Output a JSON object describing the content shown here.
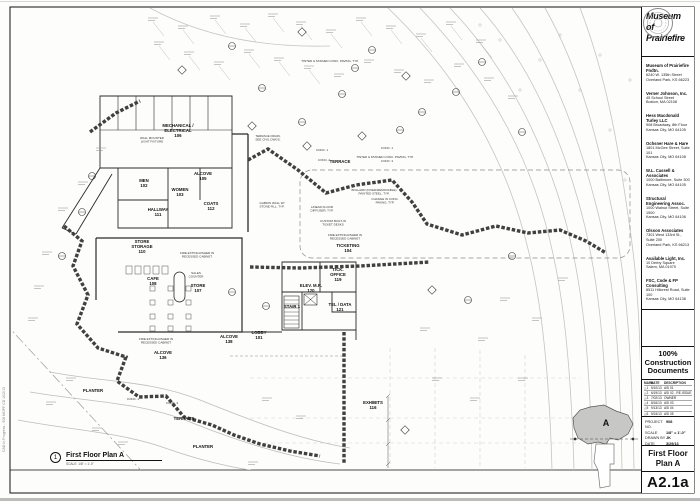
{
  "titleblock": {
    "firm": [
      "Museum",
      "of",
      "Prairiefire"
    ],
    "consultants": [
      {
        "name": "Museum of Prairiefire Fndtn.",
        "addr1": "6240 W. 135th Street",
        "addr2": "Overland Park, KS 66223"
      },
      {
        "name": "Verner Johnson, Inc.",
        "addr1": "45 School Street",
        "addr2": "Boston, MA 02108"
      },
      {
        "name": "Hess Macdonald Turley LLC",
        "addr1": "908 Broadway, 8th Floor",
        "addr2": "Kansas City, MO 64105"
      },
      {
        "name": "Ochsner Hare & Hare",
        "addr1": "1801 McGee Street, Suite 101",
        "addr2": "Kansas City, MO 64108"
      },
      {
        "name": "W.L. Cassell & Associates",
        "addr1": "1000 Baltimore, Suite 300",
        "addr2": "Kansas City, MO 64105"
      },
      {
        "name": "Structural Engineering Assoc.",
        "addr1": "1000 Walnut Street, Suite 1500",
        "addr2": "Kansas City, MO 64106"
      },
      {
        "name": "Olsson Associates",
        "addr1": "7301 West 133rd St., Suite 200",
        "addr2": "Overland Park, KS 66213"
      },
      {
        "name": "Available Light, Inc.",
        "addr1": "10 Derby Square",
        "addr2": "Salem, MA 01970"
      },
      {
        "name": "FSC, Code & FP Consulting",
        "addr1": "8511 Hillcrest Road, Suite 100",
        "addr2": "Kansas City, MO 64138"
      },
      {
        "name": "Studio M Consultants",
        "addr1": "7000 State Line Rd., Suite 215",
        "addr2": "Prairie Village, KS 66208"
      }
    ],
    "status": [
      "100%",
      "Construction",
      "Documents"
    ],
    "revisions": {
      "headers": [
        "MARK",
        "DATE",
        "DESCRIPTION"
      ],
      "rows": [
        {
          "mark": "1",
          "date": "5/10/13",
          "desc": "ASI 01"
        },
        {
          "mark": "2",
          "date": "6/19/13",
          "desc": "ASI 02 - RE-ISSUE"
        },
        {
          "mark": "3",
          "date": "7/02/13",
          "desc": "OWNER ENHANCEMENTS"
        },
        {
          "mark": "4",
          "date": "8/16/13",
          "desc": "ASI 03"
        },
        {
          "mark": "5",
          "date": "9/13/13",
          "desc": "ASI 04"
        },
        {
          "mark": "6",
          "date": "9/24/13",
          "desc": "ASI 05"
        },
        {
          "mark": "7",
          "date": "10/2/13",
          "desc": "ASI 06"
        }
      ]
    },
    "project": [
      {
        "label": "PROJECT NO.",
        "value": "908"
      },
      {
        "label": "SCALE",
        "value": "1/8\" = 1'-0\""
      },
      {
        "label": "DRAWN BY",
        "value": "JK"
      },
      {
        "label": "DATE",
        "value": "3/29/13"
      }
    ],
    "sheet_title": [
      "First Floor",
      "Plan A"
    ],
    "sheet_number": "A2.1a"
  },
  "keyplan": {
    "area_label": "A"
  },
  "drawing_title": {
    "number": "1",
    "name": "First Floor Plan A",
    "scale": "SCALE: 1/8\" = 1'-0\""
  },
  "plot_stamp": "CAD In Progress - 908 MOPF CD 10/2/13",
  "plan": {
    "rooms": [
      {
        "lines": [
          "MECHANICAL /",
          "ELECTRICAL",
          "106"
        ],
        "x": 178,
        "y": 127
      },
      {
        "lines": [
          "MEN",
          "102"
        ],
        "x": 144,
        "y": 182
      },
      {
        "lines": [
          "WOMEN",
          "103"
        ],
        "x": 180,
        "y": 191
      },
      {
        "lines": [
          "ALCOVE",
          "105"
        ],
        "x": 203,
        "y": 175
      },
      {
        "lines": [
          "HALLWAY",
          "111"
        ],
        "x": 158,
        "y": 211
      },
      {
        "lines": [
          "COATS",
          "112"
        ],
        "x": 211,
        "y": 205
      },
      {
        "lines": [
          "TERRACE"
        ],
        "x": 340,
        "y": 163,
        "fs": 5
      },
      {
        "lines": [
          "STORE",
          "STORAGE",
          "110"
        ],
        "x": 142,
        "y": 243
      },
      {
        "lines": [
          "CAFE",
          "108"
        ],
        "x": 153,
        "y": 280
      },
      {
        "lines": [
          "STORE",
          "107"
        ],
        "x": 198,
        "y": 287
      },
      {
        "lines": [
          "TICKETING",
          "104"
        ],
        "x": 348,
        "y": 247
      },
      {
        "lines": [
          "TICK.",
          "OFFICE",
          "119"
        ],
        "x": 338,
        "y": 271
      },
      {
        "lines": [
          "ELEV. M.R.",
          "120"
        ],
        "x": 311,
        "y": 287
      },
      {
        "lines": [
          "STAIR 1"
        ],
        "x": 292,
        "y": 308
      },
      {
        "lines": [
          "TEL / DATA",
          "121"
        ],
        "x": 340,
        "y": 306
      },
      {
        "lines": [
          "LOBBY",
          "101"
        ],
        "x": 259,
        "y": 334
      },
      {
        "lines": [
          "ALCOVE",
          "138"
        ],
        "x": 229,
        "y": 338
      },
      {
        "lines": [
          "ALCOVE",
          "136"
        ],
        "x": 163,
        "y": 354
      },
      {
        "lines": [
          "EXHIBITS",
          "116"
        ],
        "x": 373,
        "y": 404
      },
      {
        "lines": [
          "PLANTER"
        ],
        "x": 93,
        "y": 392,
        "fs": 5
      },
      {
        "lines": [
          "TERRACE"
        ],
        "x": 184,
        "y": 420,
        "fs": 5
      },
      {
        "lines": [
          "PLANTER"
        ],
        "x": 203,
        "y": 448,
        "fs": 5
      }
    ],
    "notes": [
      {
        "lines": [
          "TERRACE DRAIN,",
          "SEE CIVIL DWGS."
        ],
        "x": 268,
        "y": 137
      },
      {
        "lines": [
          "TINTED & STAINED CONC. PAVING, TYP."
        ],
        "x": 385,
        "y": 158
      },
      {
        "lines": [
          "TINTED & STAINED CONC. PAVING, TYP."
        ],
        "x": 330,
        "y": 62
      },
      {
        "lines": [
          "FIRE EXTINGUISHER IN",
          "RECESSED CABINET"
        ],
        "x": 345,
        "y": 236
      },
      {
        "lines": [
          "FIRE EXTINGUISHER IN",
          "RECESSED CABINET"
        ],
        "x": 197,
        "y": 254
      },
      {
        "lines": [
          "FIRE EXTINGUISHER IN",
          "RECESSED CABINET"
        ],
        "x": 156,
        "y": 340
      },
      {
        "lines": [
          "SALES",
          "COUNTER"
        ],
        "x": 196,
        "y": 274
      },
      {
        "lines": [
          "CUSTOM BUILT-IN",
          "TICKET DESKS"
        ],
        "x": 333,
        "y": 222
      },
      {
        "lines": [
          "BOLLARD (FIXED/REMOVABLE)",
          "PAINTED STEEL, TYP."
        ],
        "x": 374,
        "y": 191
      },
      {
        "lines": [
          "CHANGE IN CONC.",
          "PAVING, TYP."
        ],
        "x": 385,
        "y": 200
      },
      {
        "lines": [
          "LINEAR FLOOR",
          "DIFFUSER, TYP."
        ],
        "x": 322,
        "y": 208
      },
      {
        "lines": [
          "WALL MOUNTED",
          "LIGHT FIXTURE"
        ],
        "x": 152,
        "y": 139
      },
      {
        "lines": [
          "GABION WALL W/",
          "STONE FILL, TYP."
        ],
        "x": 272,
        "y": 204
      },
      {
        "lines": [
          "CONC. 1"
        ],
        "x": 322,
        "y": 151
      },
      {
        "lines": [
          "CONC. 2"
        ],
        "x": 324,
        "y": 161
      },
      {
        "lines": [
          "CONC. 3"
        ],
        "x": 387,
        "y": 162
      },
      {
        "lines": [
          "CONC. 1"
        ],
        "x": 387,
        "y": 149
      },
      {
        "lines": [
          "CONC. 1"
        ],
        "x": 133,
        "y": 400
      },
      {
        "lines": [
          "CONC. 3"
        ],
        "x": 172,
        "y": 404
      }
    ]
  }
}
